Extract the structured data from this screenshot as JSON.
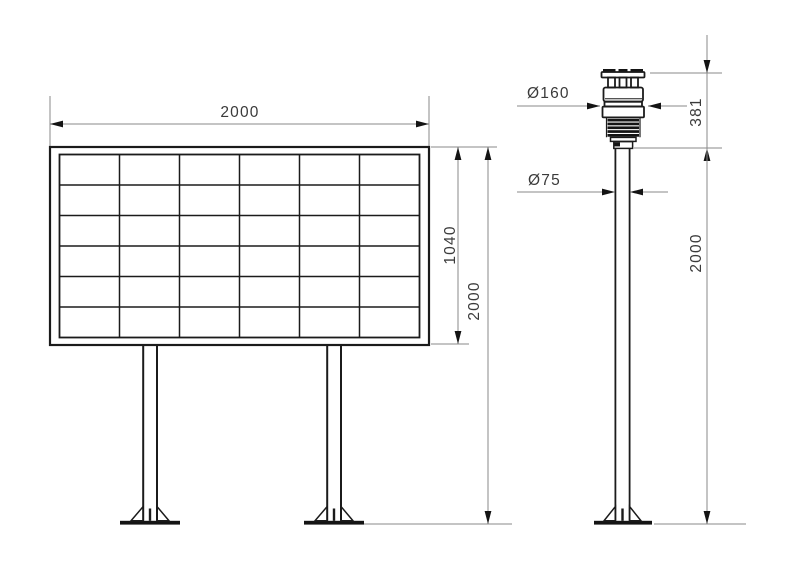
{
  "drawing": {
    "kind": "engineering-dimension-drawing",
    "colors": {
      "object_line": "#1b1b1b",
      "dimension_line": "#8a8a8a",
      "text": "#3a3a3a",
      "arrow": "#141414",
      "background": "#ffffff"
    },
    "views": {
      "board": {
        "name": "display board front view",
        "grid_columns": 6,
        "grid_rows": 6,
        "dim_width_label": "2000",
        "dim_panel_height_label": "1040",
        "dim_total_height_label": "2000"
      },
      "pole": {
        "name": "weather sensor pole side view",
        "dim_sensor_diameter_label": "Ø160",
        "dim_sensor_height_label": "381",
        "dim_pole_diameter_label": "Ø75",
        "dim_pole_height_label": "2000"
      }
    }
  }
}
